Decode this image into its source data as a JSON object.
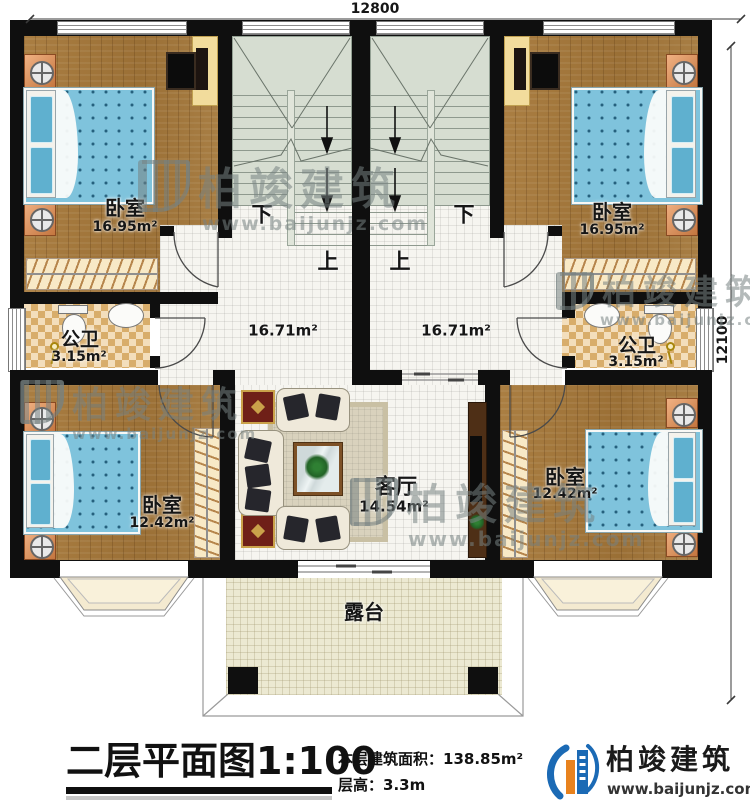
{
  "dimensions": {
    "top": "12800",
    "right": "12100"
  },
  "rooms": {
    "bedroom_tl": {
      "name": "卧室",
      "area": "16.95m²"
    },
    "bedroom_tr": {
      "name": "卧室",
      "area": "16.95m²"
    },
    "bath_l": {
      "name": "公卫",
      "area": "3.15m²"
    },
    "bath_r": {
      "name": "公卫",
      "area": "3.15m²"
    },
    "hall_l": {
      "area": "16.71m²"
    },
    "hall_r": {
      "area": "16.71m²"
    },
    "living": {
      "name": "客厅",
      "area": "14.54m²"
    },
    "bedroom_bl": {
      "name": "卧室",
      "area": "12.42m²"
    },
    "bedroom_br": {
      "name": "卧室",
      "area": "12.42m²"
    },
    "terrace": {
      "name": "露台"
    }
  },
  "stairs": {
    "down": "下",
    "up": "上"
  },
  "title_block": {
    "title": "二层平面图",
    "scale": "1:100",
    "area_label": "本层建筑面积：",
    "area_value": "138.85m²",
    "height_label": "层高：",
    "height_value": "3.3m"
  },
  "brand": {
    "name": "柏竣建筑",
    "website": "www.baijunjz.com"
  },
  "watermark": {
    "name": "柏竣建筑",
    "website": "www.baijunjz.com"
  },
  "colors": {
    "wall": "#0f0f0f",
    "wood": "#a5793c",
    "checker": "#d8ad6b",
    "stair": "#d6ddd1",
    "terrace": "#ece9d2",
    "bed": "#7fc3dc",
    "brand_blue": "#1b6ab5",
    "brand_orange": "#e8821e"
  }
}
